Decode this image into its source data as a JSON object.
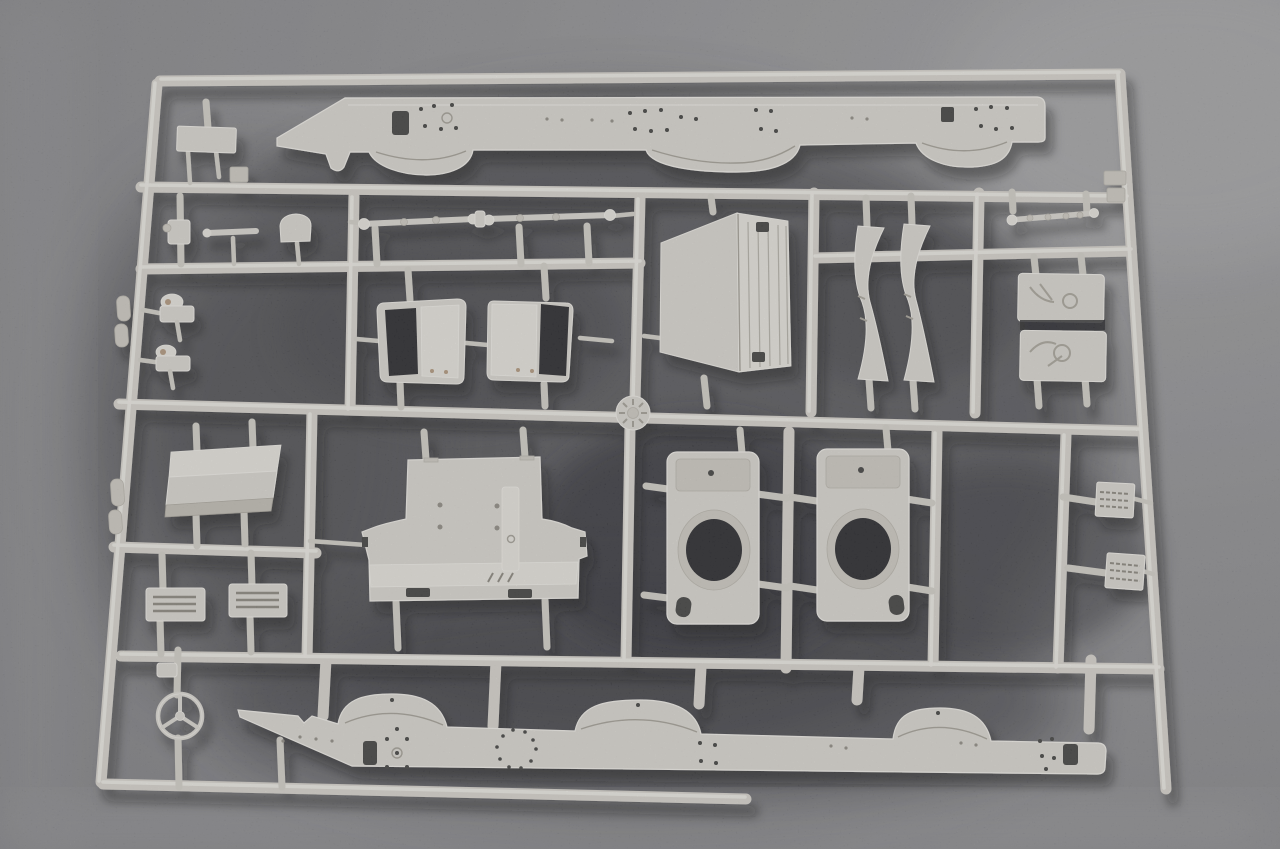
{
  "scene": {
    "type": "photograph",
    "subject": "injection-molded plastic model kit sprue (parts tree) for a truck kit",
    "material": "unpainted light-grey styrene",
    "background": "dark speckled grey surface with soft cast shadows",
    "markings": "no text or printed markings visible",
    "emblem": "three-pointed star steering-wheel emblem part at lower left"
  },
  "palette": {
    "background_mid": "#8b8b8e",
    "background_light": "#a3a3a5",
    "background_shadow": "#3f4044",
    "background_deep": "#2c2c30",
    "plastic_base": "#dcd9d2",
    "plastic_highlight": "#efede7",
    "plastic_mid": "#cfccc3",
    "plastic_edge_shadow": "#a39f95",
    "hole_dark": "#232327",
    "detail_tan": "#b2987b",
    "cast_shadow": "#101014"
  },
  "parts": [
    {
      "id": "chassis-rail-top",
      "label": "Ladder-frame side rail with wheel-arch fenders (upper)",
      "quantity": 1
    },
    {
      "id": "chassis-rail-bottom",
      "label": "Ladder-frame side rail with wheel-arch fenders (lower, mirrored)",
      "quantity": 1
    },
    {
      "id": "steering-emblem",
      "label": "Steering wheel with three-pointed star emblem",
      "quantity": 1
    },
    {
      "id": "cab-rear-panel",
      "label": "Large cab panel with ribbed edge flange",
      "quantity": 1
    },
    {
      "id": "cab-floor-panel",
      "label": "Large T-shaped cab floor panel with centre rib",
      "quantity": 1
    },
    {
      "id": "cab-door-frame",
      "label": "Cab door frame with dark window opening",
      "quantity": 2
    },
    {
      "id": "wheel-housing",
      "label": "Wheel housing box with round axle opening",
      "quantity": 2
    },
    {
      "id": "mudguard-brace",
      "label": "Curved mudguard brace strip",
      "quantity": 2
    },
    {
      "id": "equipment-box",
      "label": "Equipment box with moulded hose detail",
      "quantity": 2
    },
    {
      "id": "wind-deflector",
      "label": "Folded wind deflector panel",
      "quantity": 1
    },
    {
      "id": "vented-plate",
      "label": "Small vented step plate",
      "quantity": 2
    },
    {
      "id": "tread-step",
      "label": "Small tread-plate step",
      "quantity": 2
    },
    {
      "id": "tie-rod-linkage",
      "label": "Steering tie rods with ball ends",
      "quantity": 1
    },
    {
      "id": "small-linkage",
      "label": "Short linkage rod with ball ends",
      "quantity": 1
    },
    {
      "id": "mounting-plate",
      "label": "Small rectangular mounting plate",
      "quantity": 1
    },
    {
      "id": "crank-bracket",
      "label": "Small crank bracket",
      "quantity": 1
    },
    {
      "id": "rod-knob",
      "label": "Small rod with round pad",
      "quantity": 1
    },
    {
      "id": "seat-base",
      "label": "Small seat-shaped bracket",
      "quantity": 1
    },
    {
      "id": "hinge-bracket",
      "label": "Small hinge bracket with pin",
      "quantity": 2
    },
    {
      "id": "sprue-gate",
      "label": "Central injection gate disc",
      "quantity": 1
    },
    {
      "id": "clip-tab",
      "label": "Small clip tab",
      "quantity": 2
    }
  ]
}
